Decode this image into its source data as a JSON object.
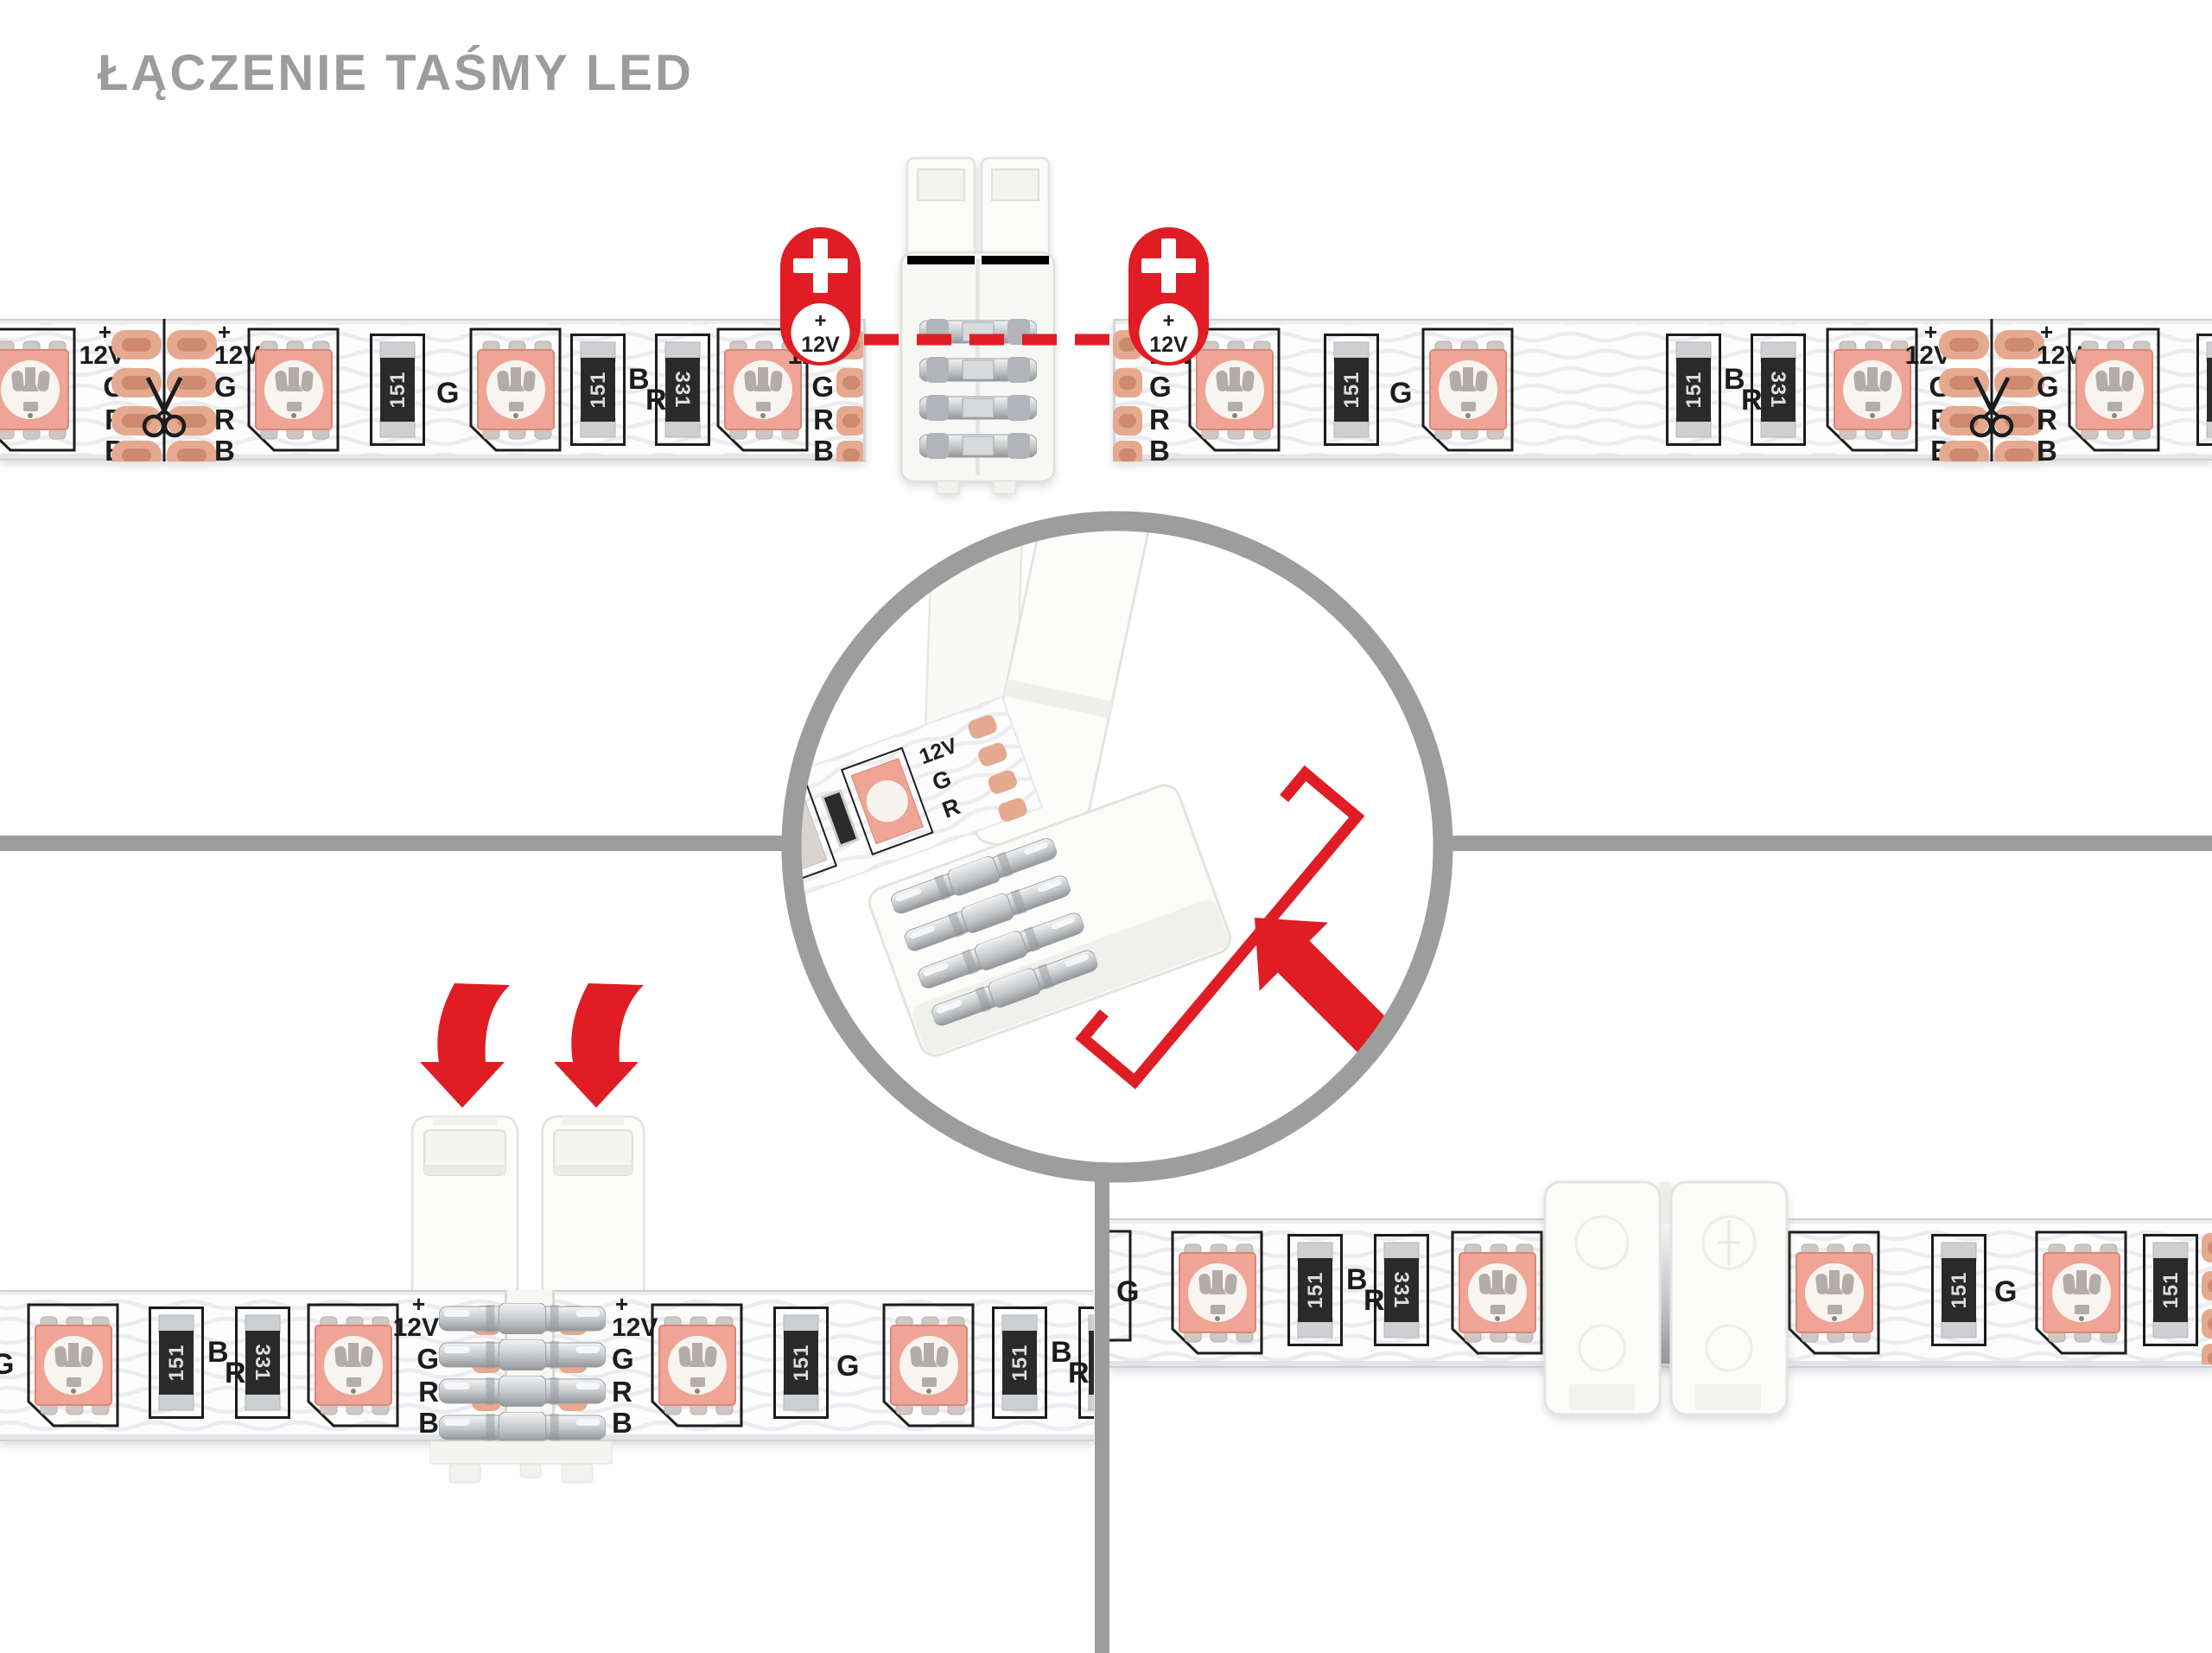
{
  "title": {
    "text": "ŁĄCZENIE TAŚMY LED"
  },
  "palette": {
    "title_gray": "#9c9c9c",
    "line_gray": "#9d9d9d",
    "red": "#e01d24",
    "print": "#1f1f1f",
    "copper": "#e5a98f",
    "copper_inner": "#cd8a6e",
    "led_body": "#f0a496",
    "strip_white": "#fdfdfd"
  },
  "strip_print": {
    "plus": "+",
    "voltage": "12V",
    "chan_g": "G",
    "chan_r": "R",
    "chan_b": "B",
    "resistor_151": "151",
    "resistor_331": "331"
  },
  "marker": {
    "symbol": "+",
    "window_plus": "+",
    "window_voltage": "12V"
  },
  "inset": {
    "voltage": "12V",
    "chan_g": "G",
    "chan_r": "R"
  },
  "icons": {
    "plus_marker": "plus-badge",
    "scissors_cut_mark": "scissors",
    "press_down_arrow": "curved-arrow-down",
    "insert_direction_arrow": "arrow-up-left",
    "magnifier_circle": "zoom-detail-ring"
  }
}
